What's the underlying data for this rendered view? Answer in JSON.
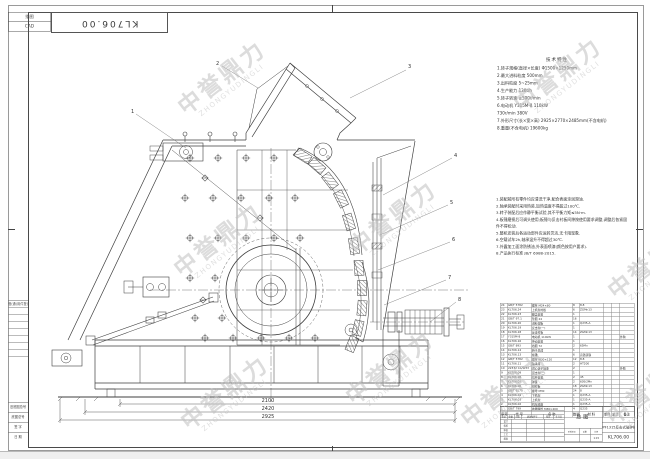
{
  "sheet": {
    "corner_code": "KL706.00",
    "margin": {
      "top_boxes": [
        "描图",
        "CAD"
      ],
      "register_label": "借(通)用件登记",
      "bottom_labels": [
        "旧底图总号",
        "底图总号",
        "签 字",
        "日 期"
      ]
    },
    "watermark": {
      "text": "中誉鼎力",
      "subtext": "ZHONGYUDINGLI",
      "color": "#c0c0c0",
      "positions": [
        [
          222,
          78
        ],
        [
          558,
          75
        ],
        [
          218,
          240
        ],
        [
          393,
          218
        ],
        [
          652,
          262
        ],
        [
          225,
          393
        ],
        [
          390,
          368
        ],
        [
          505,
          390
        ],
        [
          650,
          388
        ]
      ]
    }
  },
  "spec": {
    "title": "技术特性",
    "lines": [
      "1.转子规格(直径×长度)  Φ1500×1250mm",
      "2.最大进料粒度  500mm",
      "3.出料粒度  5~25mm",
      "4.生产能力  130t/h",
      "5.转子转速  ≤500r/min",
      "6.电动机  Y315M-8  110kW",
      "     730r/min  380V",
      "7.外形尺寸(长×宽×高) 2925×2770×2485mm(不含电机)",
      "8.重量(不含电机)  19600kg"
    ]
  },
  "notes": {
    "lines": [
      "1.装配前所有零件均应清洗干净,配合表面涂润滑油.",
      "2.轴承装配时采用热装,加热温度不得超过100℃.",
      "3.转子装配后应作静平衡试验,其不平衡力矩≤5N·m.",
      "4.板锤磨损后可调头使用;板锤与反击衬板间隙按使用要求调整,调整后各紧固件不得松动.",
      "5.整机安装后各运动部件应运转灵活,无卡阻现象.",
      "6.空载试车2h,轴承温升不得超过30℃.",
      "7.外露加工面涂防锈油,外表面喷漆(颜色按用户要求).",
      "8.产品执行标准 JB/T 6988-2015."
    ]
  },
  "drawing": {
    "callouts": [
      "1",
      "2",
      "3",
      "4",
      "5",
      "6",
      "7",
      "8"
    ],
    "dims": [
      "2100",
      "2420",
      "2925"
    ]
  },
  "bom": {
    "headers": [
      "序号",
      "代  号",
      "名  称",
      "数量",
      "材  料",
      "单件",
      "总计",
      "备注"
    ],
    "rows": [
      [
        "24",
        "GB/T 5782",
        "螺栓 M24×80",
        "8",
        "8.8",
        "",
        "",
        ""
      ],
      [
        "23",
        "KL706.24",
        "上机架衬板",
        "6",
        "ZGMn13",
        "",
        "",
        ""
      ],
      [
        "22",
        "KL706.23",
        "翻盖装置",
        "1",
        "",
        "",
        "",
        ""
      ],
      [
        "21",
        "GB/T 97.1",
        "垫圈 24",
        "16",
        "",
        "",
        "",
        ""
      ],
      [
        "20",
        "KL706.20",
        "进料溜板",
        "1",
        "Q235-A",
        "",
        "",
        ""
      ],
      [
        "19",
        "KL706.19",
        "反击架(一)",
        "1",
        "",
        "",
        "",
        ""
      ],
      [
        "18",
        "KL706.18",
        "反击衬板",
        "14",
        "ZGMn13",
        "",
        "",
        ""
      ],
      [
        "17",
        "Y315M-8",
        "电动机 110kW",
        "1",
        "",
        "",
        "",
        "外购"
      ],
      [
        "16",
        "KL706.16",
        "传动装置",
        "1",
        "",
        "",
        "",
        ""
      ],
      [
        "15",
        "GB/T 893",
        "挡圈 72",
        "2",
        "65Mn",
        "",
        "",
        ""
      ],
      [
        "14",
        "KL706.14",
        "转子总成",
        "1",
        "",
        "",
        "",
        ""
      ],
      [
        "13",
        "KL706.13",
        "板锤",
        "6",
        "高铬铸铁",
        "",
        "",
        ""
      ],
      [
        "12",
        "GB/T 5782",
        "螺栓 M30×120",
        "12",
        "8.8",
        "",
        "",
        ""
      ],
      [
        "11",
        "KL706.11",
        "轴承座",
        "2",
        "HT200",
        "",
        "",
        ""
      ],
      [
        "10",
        "22332 CA/W33",
        "调心滚子轴承",
        "2",
        "",
        "",
        "",
        "外购"
      ],
      [
        "9",
        "KL706.09",
        "反击架(二)",
        "1",
        "",
        "",
        "",
        ""
      ],
      [
        "8",
        "KL706.08",
        "拉杆装置",
        "2",
        "45",
        "",
        "",
        ""
      ],
      [
        "7",
        "KL706.07",
        "弹簧",
        "2",
        "60Si2Mn",
        "",
        "",
        ""
      ],
      [
        "6",
        "KL706.06",
        "侧衬板",
        "18",
        "ZGMn13",
        "",
        "",
        ""
      ],
      [
        "5",
        "GB/T 6170",
        "螺母 M30",
        "24",
        "8",
        "",
        "",
        ""
      ],
      [
        "4",
        "KL706.04",
        "下机架",
        "1",
        "Q235-A",
        "",
        "",
        ""
      ],
      [
        "3",
        "KL706.03",
        "上机架",
        "1",
        "Q235-A",
        "",
        "",
        ""
      ],
      [
        "2",
        "KL706.02",
        "机架底座",
        "1",
        "Q235-A",
        "",
        "",
        ""
      ],
      [
        "1",
        "GB/T 799",
        "地脚螺栓 M36×400",
        "4",
        "Q235",
        "",
        "",
        ""
      ]
    ]
  },
  "title_block": {
    "view_label": "总图",
    "product": "PF1315反击式破碎机",
    "drawing_no": "KL706.00",
    "scale": "1:15",
    "rev_headers": [
      "标记",
      "处数",
      "分区",
      "更改文件号",
      "签名",
      "年月日"
    ],
    "sig_labels": [
      "设计",
      "校核",
      "审核",
      "工艺",
      "批准"
    ],
    "aux_labels": [
      "阶段标记",
      "重量",
      "比例"
    ]
  }
}
